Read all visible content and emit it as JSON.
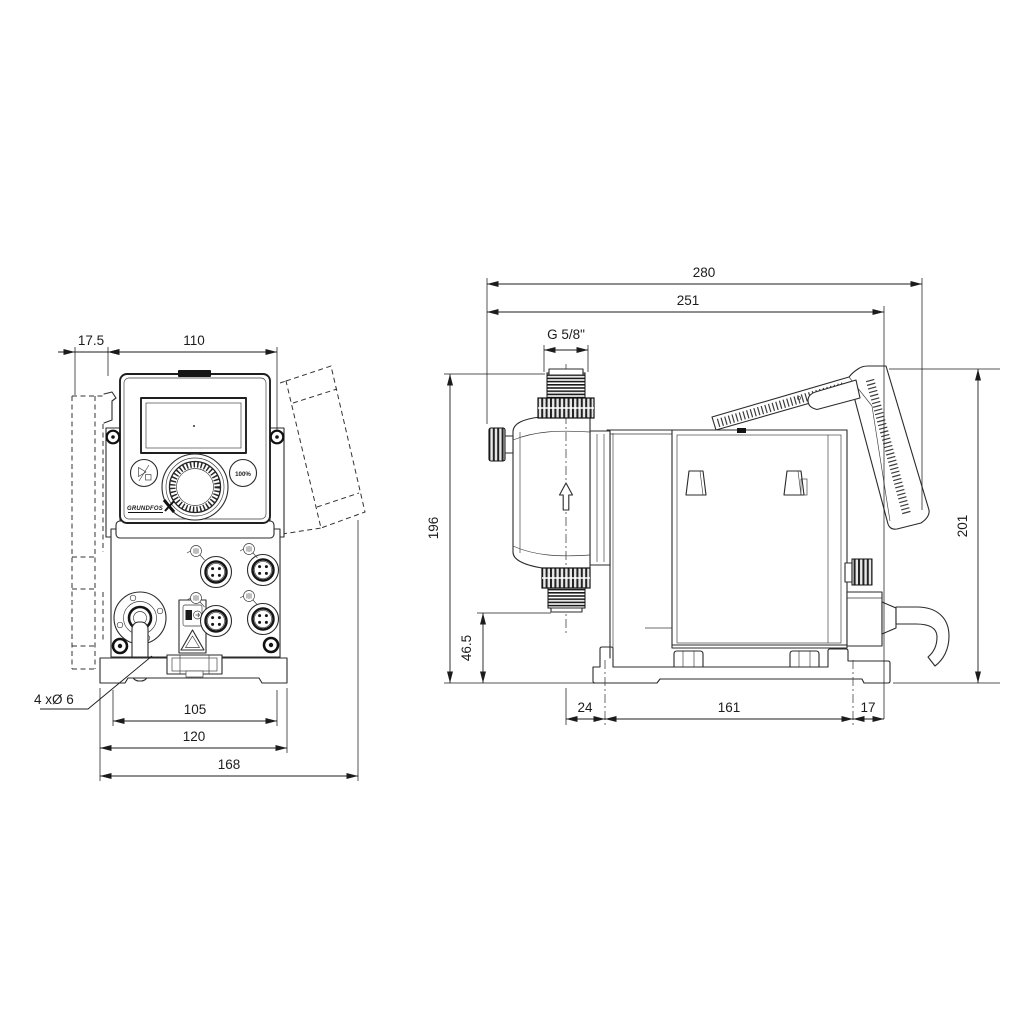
{
  "drawing": {
    "front_view": {
      "dim_offset": "17.5",
      "dim_panel_width": "110",
      "dim_hole_spacing": "105",
      "dim_plate_width": "120",
      "dim_total_width": "168",
      "note_mounting_holes": "4 xØ 6",
      "button_100_label": "100%",
      "logo_text": "GRUNDFOS"
    },
    "side_view": {
      "dim_total_depth": "280",
      "dim_depth_to_hood": "251",
      "dim_thread": "G 5/8\"",
      "dim_height": "196",
      "dim_outlet_height": "46.5",
      "dim_base_front": "24",
      "dim_hole_spacing": "161",
      "dim_base_rear": "17",
      "dim_hood_height": "201"
    }
  }
}
